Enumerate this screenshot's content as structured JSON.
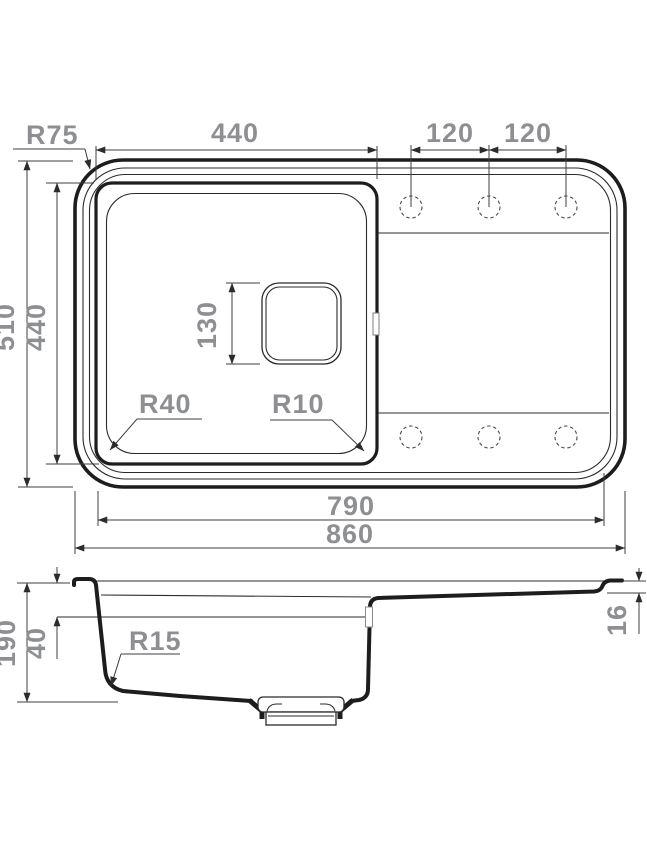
{
  "colors": {
    "outline": "#1d1d1b",
    "dim_line": "#3f3f3f",
    "dim_text": "#8e8f92",
    "background": "#ffffff"
  },
  "top_view": {
    "labels": {
      "corner_radius": "R75",
      "bowl_width": "440",
      "hole_pitch_1": "120",
      "hole_pitch_2": "120",
      "overall_depth": "510",
      "bowl_depth": "440",
      "drain_size": "130",
      "bowl_bottom_radius": "R40",
      "bowl_corner_radius": "R10",
      "rim_inner_width": "790",
      "overall_width": "860"
    }
  },
  "side_view": {
    "labels": {
      "overall_height": "190",
      "overflow_depth": "40",
      "bottom_fillet_radius": "R15",
      "drainboard_drop": "16"
    }
  }
}
